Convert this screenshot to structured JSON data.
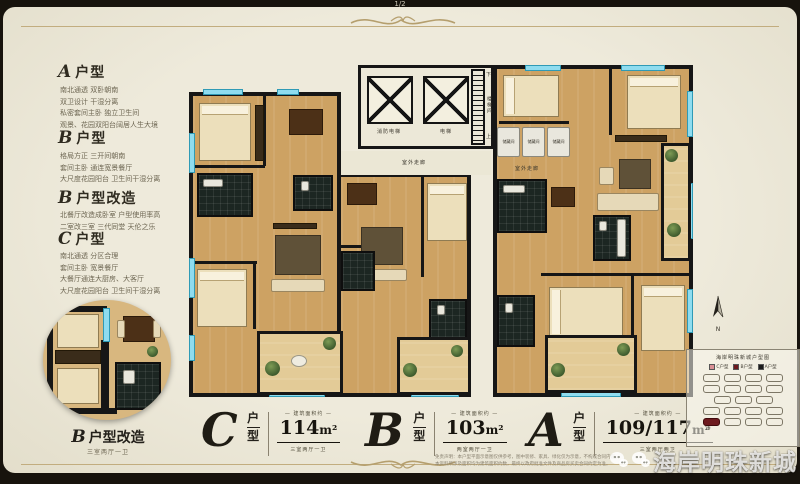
{
  "page_indicator": "1/2",
  "sidebar": {
    "sections": [
      {
        "letter": "A",
        "suffix": "户型",
        "lines": [
          "南北通透 双卧朝南",
          "双卫设计 干湿分离",
          "私密套间主卧 独立卫生间",
          "观景、花园双阳台阔居人生大境"
        ]
      },
      {
        "letter": "B",
        "suffix": "户型",
        "lines": [
          "格局方正 三开间朝南",
          "套间主卧 通连宽景餐厅",
          "大尺度花园阳台 卫生间干湿分离"
        ]
      },
      {
        "letter": "B",
        "suffix": "户型改造",
        "lines": [
          "北餐厅改造成卧室 户型使用率高",
          "二室改三室 三代同堂 天伦之乐"
        ]
      },
      {
        "letter": "C",
        "suffix": "户型",
        "lines": [
          "南北通透 分区合理",
          "套间主卧 宽景餐厅",
          "大餐厅通连大厨房、大客厅",
          "大尺度花园阳台 卫生间干湿分离"
        ]
      }
    ]
  },
  "inset": {
    "letter": "B",
    "title": "户型改造",
    "sub": "三室两厅一卫"
  },
  "plan": {
    "labels": {
      "fire_elevator": "消防电梯",
      "elevator": "电梯",
      "stairwell": "楼梯间",
      "up": "上",
      "down": "下",
      "corridor": "室外走廊",
      "storage": "储藏间"
    }
  },
  "units": [
    {
      "letter": "C",
      "hu": "户",
      "xing": "型",
      "area_label": "— 建筑面积约 —",
      "area": "114",
      "area_unit": "m²",
      "rooms": "三室两厅一卫"
    },
    {
      "letter": "B",
      "hu": "户",
      "xing": "型",
      "area_label": "— 建筑面积约 —",
      "area": "103",
      "area_unit": "m²",
      "rooms": "两室两厅一卫"
    },
    {
      "letter": "A",
      "hu": "户",
      "xing": "型",
      "area_label": "— 建筑面积约 —",
      "area": "109/117",
      "area_unit": "m²",
      "rooms": "三室两厅两卫"
    }
  ],
  "legend": {
    "title": "海岸明珠新城户型图",
    "items": [
      {
        "label": "C户型",
        "color": "#d98f94"
      },
      {
        "label": "B户型",
        "color": "#6e1a1f"
      },
      {
        "label": "A户型",
        "color": "#1c1c1c"
      }
    ],
    "building_label": "1#"
  },
  "compass": {
    "label": "N"
  },
  "watermark": {
    "text": "海岸明珠新城"
  },
  "disclaimer": {
    "line1": "免责声明：本户型平面示意图仅供参考，图中装修、家具、绿化仅为示意，不构成合同内容。",
    "line2": "本资料所涉及面积均为建筑面积约数，最终以政府批准文件及商品房买卖合同约定为准。"
  },
  "colors": {
    "accent_gold": "#c2ad7f",
    "paper": "#ebe7d5",
    "frame": "#17130d",
    "window_cyan": "#8fdcef",
    "wall": "#161616",
    "highlight_red": "#6e1a1f"
  }
}
